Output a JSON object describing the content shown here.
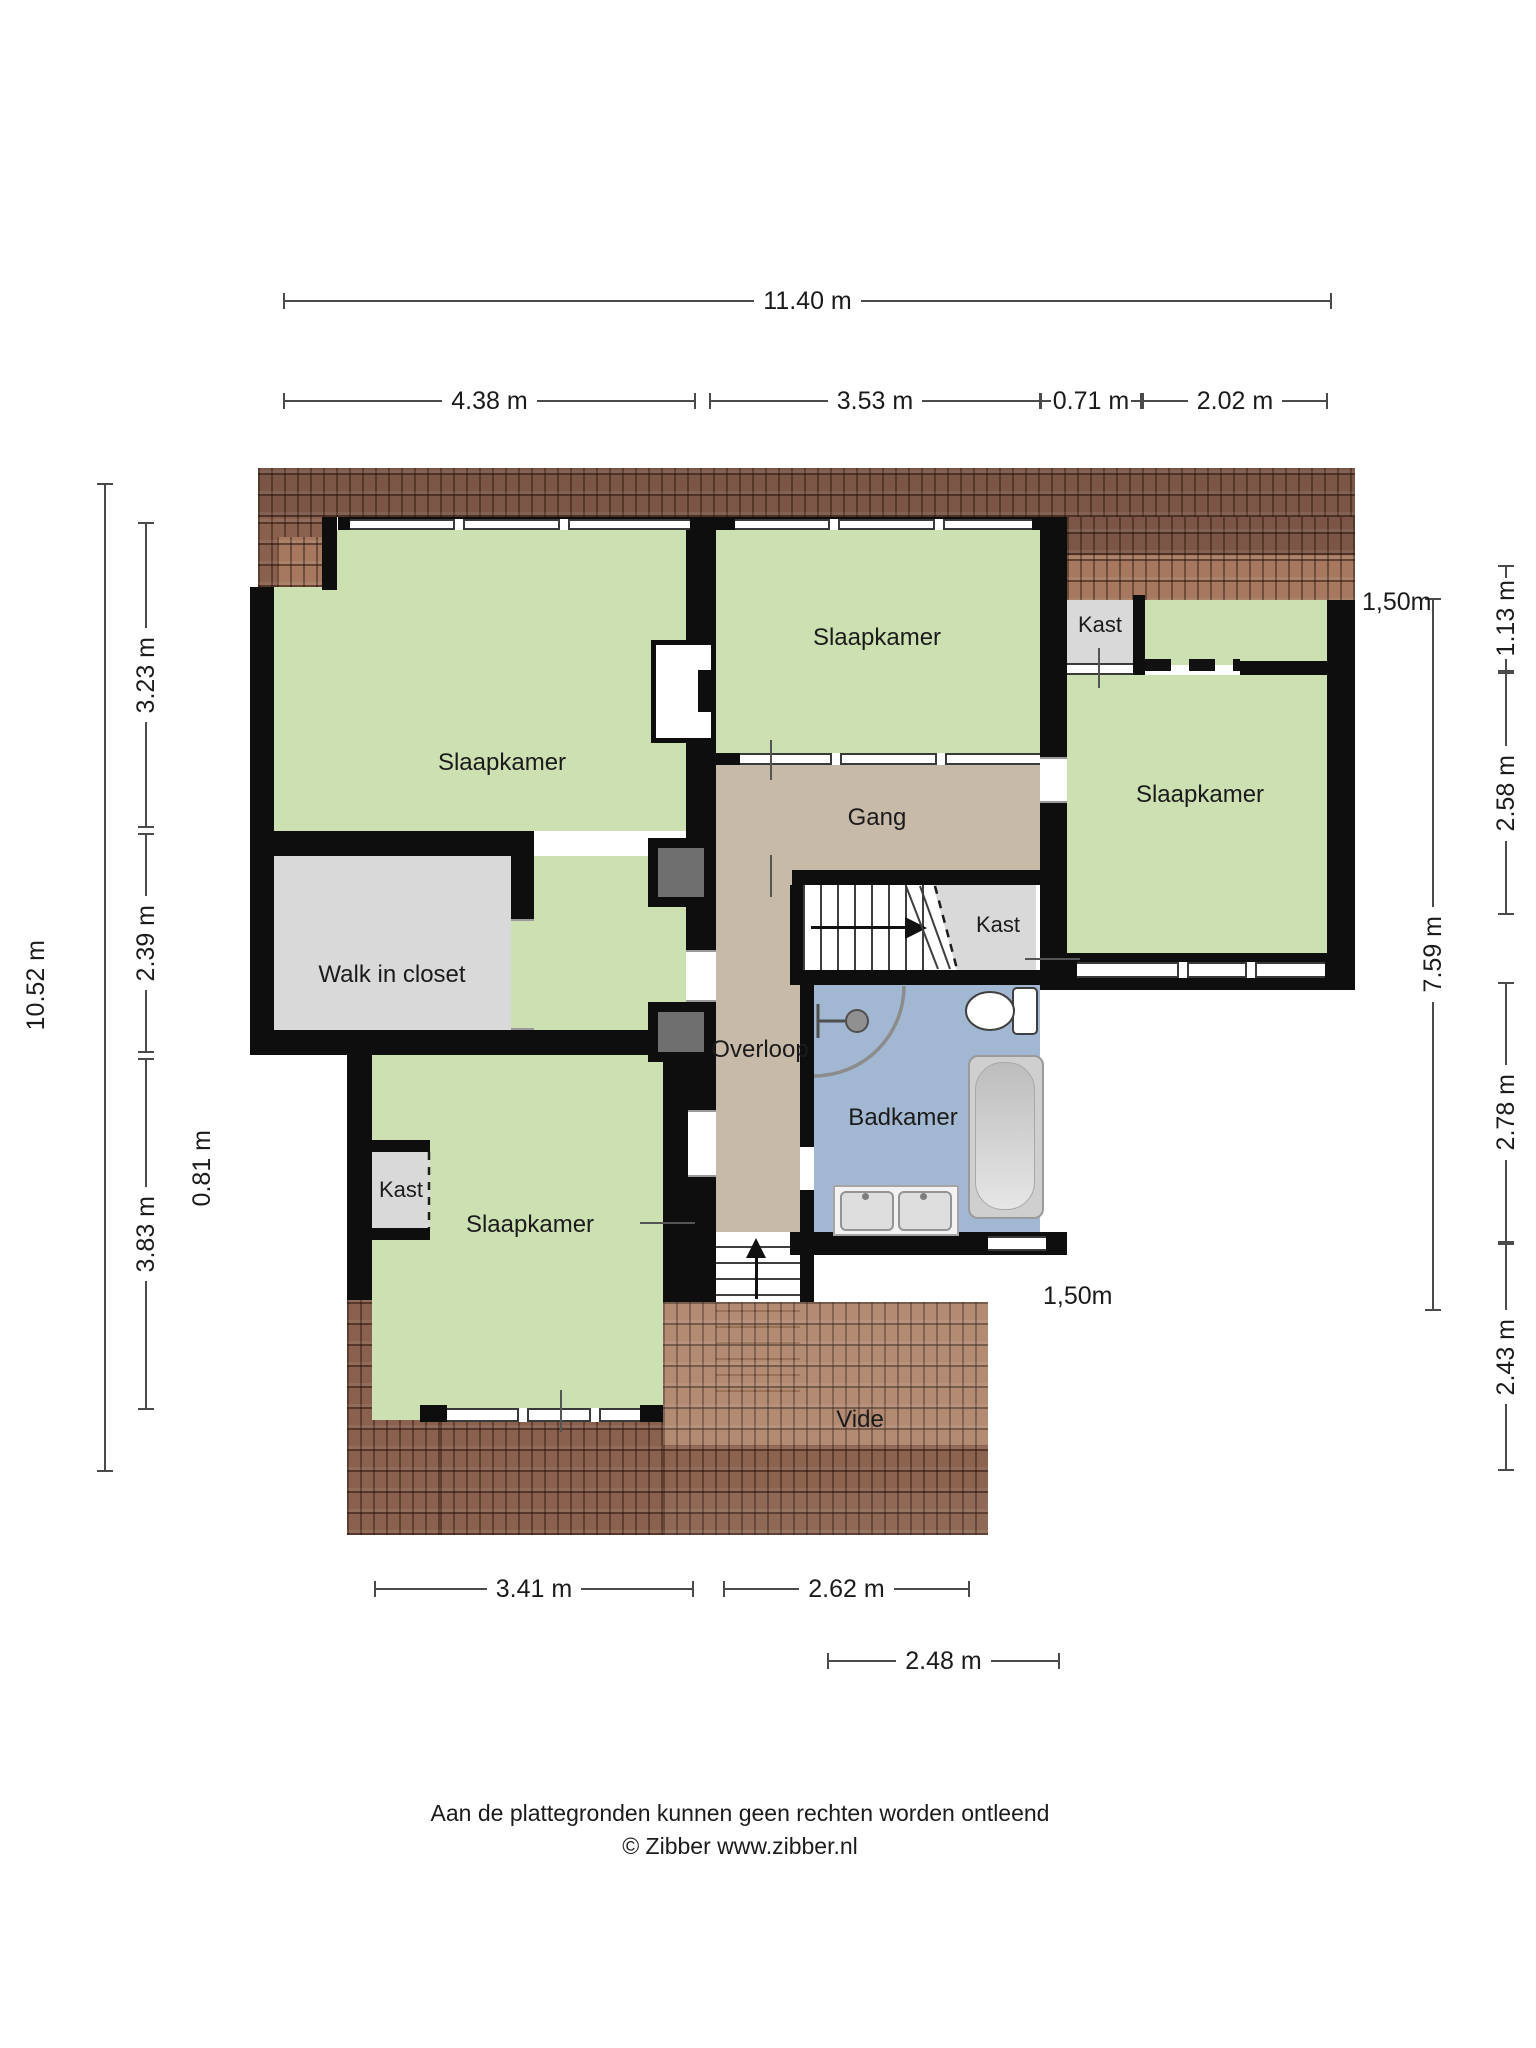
{
  "rooms": {
    "slaapkamer_top_left": "Slaapkamer",
    "slaapkamer_top_middle": "Slaapkamer",
    "slaapkamer_right": "Slaapkamer",
    "slaapkamer_bottom_left": "Slaapkamer",
    "walk_in_closet": "Walk in closet",
    "gang": "Gang",
    "overloop": "Overloop",
    "badkamer": "Badkamer",
    "vide": "Vide",
    "kast_top_right": "Kast",
    "kast_middle": "Kast",
    "kast_bottom_left": "Kast"
  },
  "dimensions": {
    "overall_width": "11.40 m",
    "top_row": [
      "4.38 m",
      "3.53 m",
      "0.71 m",
      "2.02 m"
    ],
    "left_outer": "10.52 m",
    "left_inner": [
      "3.23 m",
      "2.39 m",
      "3.83 m"
    ],
    "left_detached": "0.81 m",
    "right_inner": "7.59 m",
    "right_outer": [
      "1.13 m",
      "2.58 m",
      "2.78 m",
      "2.43 m"
    ],
    "bottom_row": [
      "3.41 m",
      "2.62 m"
    ],
    "bottom_row2": "2.48 m",
    "height_marker_top": "1,50m",
    "height_marker_bottom": "1,50m"
  },
  "footer": {
    "disclaimer": "Aan de plattegronden kunnen geen rechten worden ontleend",
    "copyright": "© Zibber www.zibber.nl"
  },
  "colors": {
    "room_green": "#cde0b2",
    "hall_taupe": "#c8baa9",
    "closet_gray": "#d9d9d9",
    "bathroom_blue": "#a2b7d1",
    "wall_black": "#0e0e0e",
    "roof_brown": "#8a614e"
  }
}
